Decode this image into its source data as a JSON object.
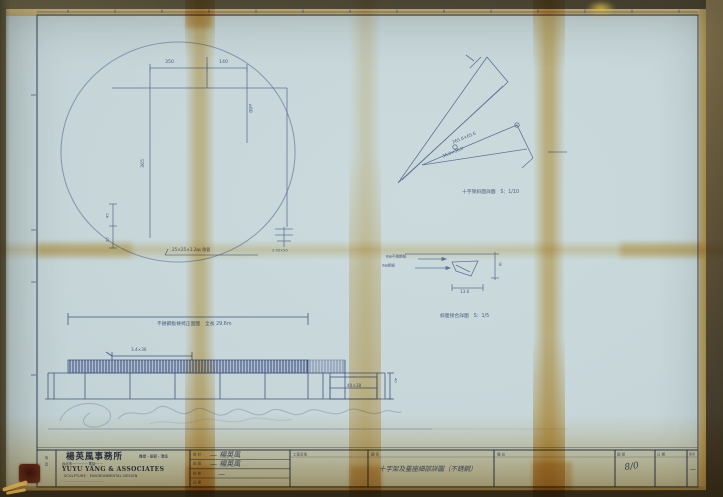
{
  "document": {
    "kind": "blueprint-photo",
    "sheet_color": "#c6d6d9",
    "ink_color": "#4a5c80",
    "stain_color": "#e0b258",
    "background_color": "#57513c"
  },
  "circle_plan": {
    "dim_top_left": "350",
    "dim_top_right": "140",
    "dim_right": "⌀60",
    "dim_left": "365",
    "dim_small_a": "45",
    "dim_small_b": "95",
    "leader_note": "25×25×1.2㎜ 角管",
    "column_note": "2-50×50"
  },
  "angular_detail": {
    "dim_a": "265.6×65.6",
    "dim_b": "36.0×36.0",
    "caption": "十字架斜面詳圖　S：1/10"
  },
  "joint_detail": {
    "label_a": "6㎜不銹鋼板",
    "label_b": "9㎜鋼板",
    "dim_w": "13.6",
    "dim_h": "8",
    "caption": "斜面接合詳圖　S：1/5"
  },
  "elevation": {
    "note": "不銹鋼板條椅正面圖　全長 29.6m",
    "dim_a": "3.4×36",
    "box_note": "40×38",
    "dim_side": "40"
  },
  "title_block": {
    "company_cn": "楊英風事務所",
    "company_cn_sub": "雕塑・景觀・環境",
    "company_addr": "台北市··············· 電話·······",
    "company_en": "YUYU YANG & ASSOCIATES",
    "company_en_sub": "SCULPTURE · ENVIRONMENTAL DESIGN",
    "company_en_sub2": "··········································",
    "side_tab": "第　頁",
    "signoff_rows": [
      {
        "label": "設 計",
        "value": "— 楊英風"
      },
      {
        "label": "繪 圖",
        "value": "— 楊英風"
      },
      {
        "label": "校 核",
        "value": "—"
      },
      {
        "label": "日 期",
        "value": ""
      }
    ],
    "project_header": "工程名稱",
    "title_header": "圖 名",
    "drawing_title": "十字架及臺座細部詳圖（不銹鋼）",
    "remarks_header": "備 註",
    "dwg_no_header": "圖 號",
    "dwg_no": "8/0",
    "date_header": "日 期",
    "sheet_header": "張次",
    "sheet_mark": "—"
  }
}
